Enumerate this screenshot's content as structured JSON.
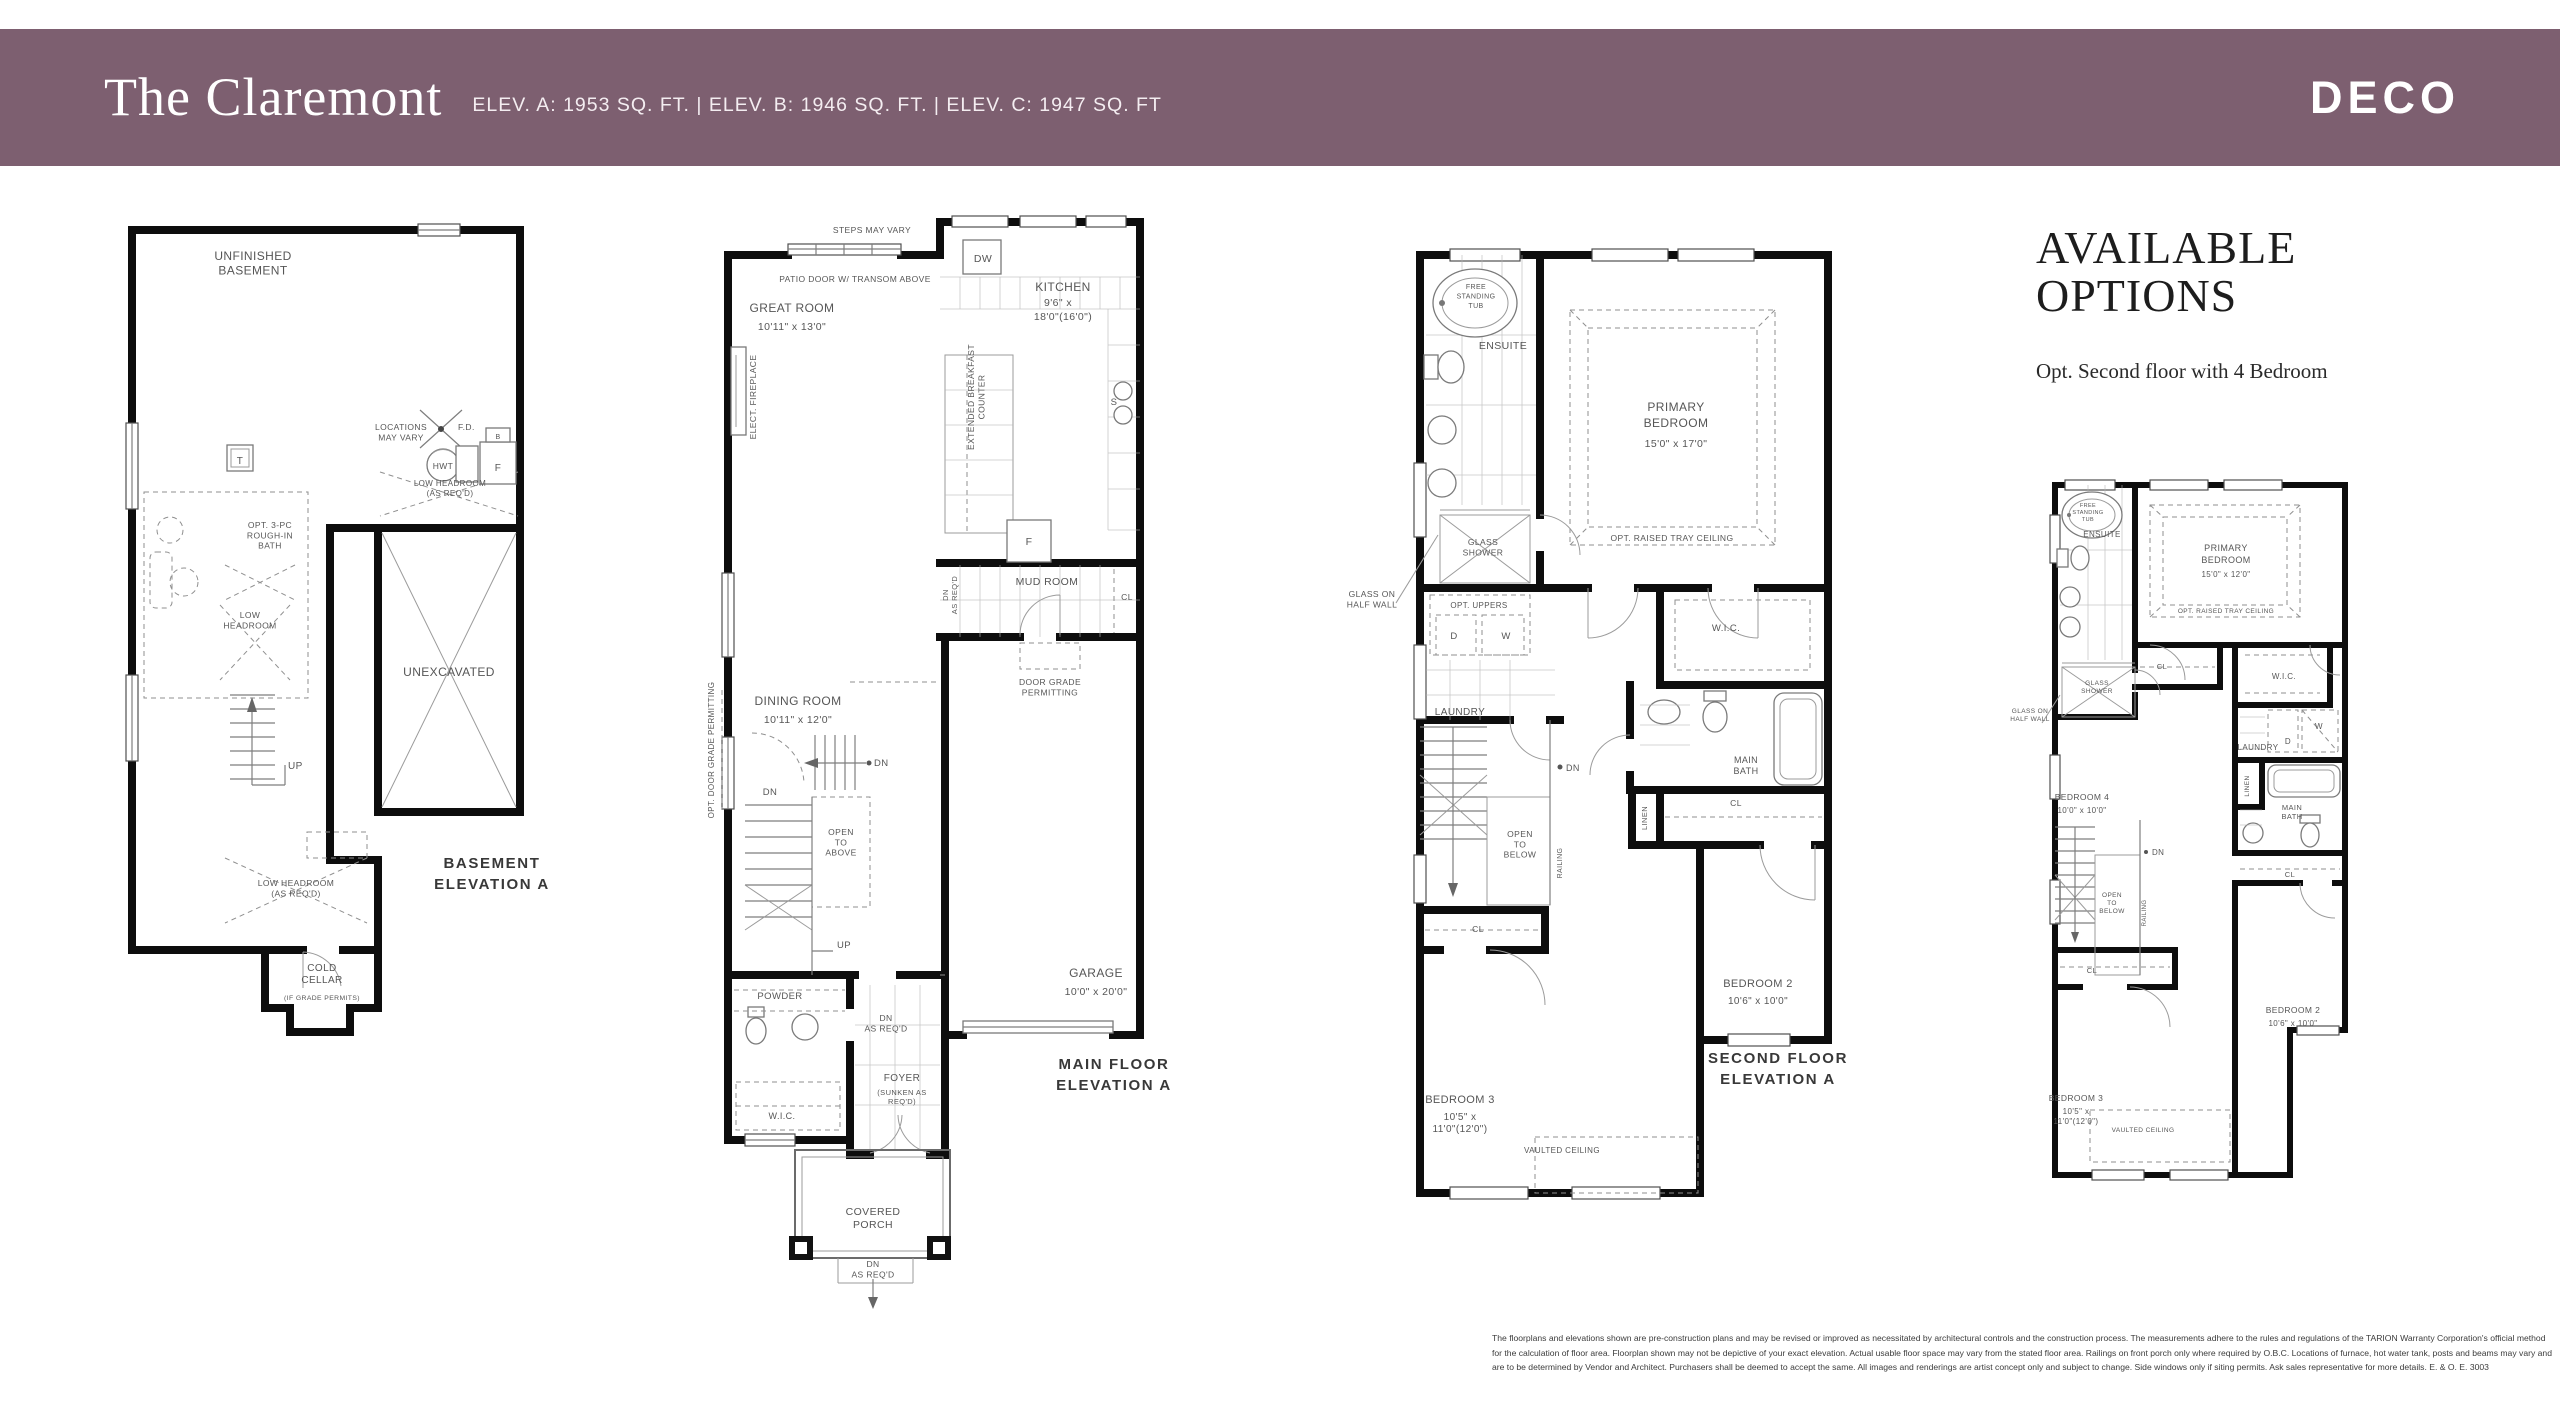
{
  "header": {
    "title": "The Claremont",
    "specs": "ELEV. A: 1953 SQ. FT.  |  ELEV. B: 1946 SQ. FT.  |  ELEV. C: 1947 SQ. FT",
    "brand": "DECO",
    "bar_color": "#7d5f70"
  },
  "options": {
    "title": "AVAILABLE\nOPTIONS",
    "subtitle": "Opt. Second floor with 4 Bedroom"
  },
  "plans": {
    "basement": {
      "labels": [
        {
          "t": "UNFINISHED\nBASEMENT",
          "x": 133,
          "y": 80,
          "s": 12,
          "ls": 1
        },
        {
          "t": "T",
          "x": 120,
          "y": 284,
          "s": 10
        },
        {
          "t": "LOCATIONS\nMAY VARY",
          "x": 281,
          "y": 250,
          "s": 8.5
        },
        {
          "t": "F.D.",
          "x": 338,
          "y": 250,
          "s": 8.5,
          "a": "start"
        },
        {
          "t": "HWT",
          "x": 323,
          "y": 289,
          "s": 8.5
        },
        {
          "t": "B",
          "x": 378,
          "y": 259,
          "s": 7
        },
        {
          "t": "F",
          "x": 378,
          "y": 291,
          "s": 10
        },
        {
          "t": "LOW HEADROOM\n(AS REQ'D)",
          "x": 330,
          "y": 306,
          "s": 8
        },
        {
          "t": "OPT. 3-PC\nROUGH-IN\nBATH",
          "x": 150,
          "y": 348,
          "s": 8.5
        },
        {
          "t": "LOW\nHEADROOM",
          "x": 130,
          "y": 438,
          "s": 8.5
        },
        {
          "t": "UP",
          "x": 168,
          "y": 589,
          "s": 10,
          "a": "start"
        },
        {
          "t": "LOW HEADROOM\n(AS REQ'D)",
          "x": 176,
          "y": 706,
          "s": 8.5
        },
        {
          "t": "UNEXCAVATED",
          "x": 329,
          "y": 496,
          "s": 12,
          "ls": 1
        },
        {
          "t": "COLD\nCELLAR",
          "x": 202,
          "y": 791,
          "s": 10,
          "ls": 0.5
        },
        {
          "t": "(IF GRADE PERMITS)",
          "x": 202,
          "y": 820,
          "s": 6.8
        },
        {
          "t": "BASEMENT\nELEVATION A",
          "x": 372,
          "y": 688,
          "s": 15,
          "c": "cap",
          "lh": 21
        }
      ]
    },
    "main": {
      "labels": [
        {
          "t": "STEPS MAY VARY",
          "x": 182,
          "y": 48,
          "s": 8.5
        },
        {
          "t": "PATIO DOOR W/ TRANSOM ABOVE",
          "x": 165,
          "y": 97,
          "s": 8.5
        },
        {
          "t": "GREAT ROOM",
          "x": 102,
          "y": 127,
          "s": 12,
          "ls": 1
        },
        {
          "t": "10'11\" x 13'0\"",
          "x": 102,
          "y": 145,
          "s": 10.5
        },
        {
          "t": "ELECT. FIREPLACE",
          "x": 66,
          "y": 212,
          "s": 8.5,
          "r": -90
        },
        {
          "t": "DW",
          "x": 293,
          "y": 77,
          "s": 10.5
        },
        {
          "t": "KITCHEN",
          "x": 373,
          "y": 106,
          "s": 12,
          "ls": 1
        },
        {
          "t": "9'6\" x",
          "x": 368,
          "y": 121,
          "s": 10.5
        },
        {
          "t": "18'0\"(16'0\")",
          "x": 373,
          "y": 135,
          "s": 10.5
        },
        {
          "t": "EXTENDED BREAKFAST\nCOUNTER",
          "x": 284,
          "y": 212,
          "s": 8.5,
          "r": -90
        },
        {
          "t": "S",
          "x": 424,
          "y": 220,
          "s": 9.5
        },
        {
          "t": "F",
          "x": 339,
          "y": 360,
          "s": 10.5
        },
        {
          "t": "MUD ROOM",
          "x": 357,
          "y": 400,
          "s": 10.5,
          "ls": 0.5
        },
        {
          "t": "DN\nAS REQ'D",
          "x": 258,
          "y": 410,
          "s": 7.5,
          "r": -90
        },
        {
          "t": "CL",
          "x": 437,
          "y": 415,
          "s": 8.5
        },
        {
          "t": "DOOR GRADE\nPERMITTING",
          "x": 360,
          "y": 500,
          "s": 8.5
        },
        {
          "t": "DINING ROOM",
          "x": 108,
          "y": 520,
          "s": 12,
          "ls": 1
        },
        {
          "t": "10'11\" x 12'0\"",
          "x": 108,
          "y": 538,
          "s": 10.5
        },
        {
          "t": "OPT. DOOR GRADE PERMITTING",
          "x": 24,
          "y": 565,
          "s": 8,
          "r": -90
        },
        {
          "t": "DN",
          "x": 184,
          "y": 581,
          "s": 9.5,
          "a": "start"
        },
        {
          "t": "DN",
          "x": 80,
          "y": 610,
          "s": 9.5
        },
        {
          "t": "OPEN\nTO\nABOVE",
          "x": 151,
          "y": 650,
          "s": 8.5
        },
        {
          "t": "UP",
          "x": 147,
          "y": 763,
          "s": 9.5,
          "a": "start"
        },
        {
          "t": "POWDER",
          "x": 90,
          "y": 814,
          "s": 9.5,
          "ls": 0.5
        },
        {
          "t": "DN\nAS REQ'D",
          "x": 196,
          "y": 836,
          "s": 8.5
        },
        {
          "t": "W.I.C.",
          "x": 92,
          "y": 934,
          "s": 9
        },
        {
          "t": "FOYER",
          "x": 212,
          "y": 896,
          "s": 10,
          "ls": 0.5
        },
        {
          "t": "(SUNKEN AS\nREQ'D)",
          "x": 212,
          "y": 910,
          "s": 7.5
        },
        {
          "t": "GARAGE",
          "x": 406,
          "y": 792,
          "s": 12,
          "ls": 1
        },
        {
          "t": "10'0\" x 20'0\"",
          "x": 406,
          "y": 810,
          "s": 10.5
        },
        {
          "t": "COVERED\nPORCH",
          "x": 183,
          "y": 1030,
          "s": 10.5,
          "ls": 0.5
        },
        {
          "t": "DN\nAS REQ'D",
          "x": 183,
          "y": 1082,
          "s": 8.5
        },
        {
          "t": "MAIN FLOOR\nELEVATION A",
          "x": 424,
          "y": 884,
          "s": 15,
          "c": "cap",
          "lh": 21
        }
      ]
    },
    "second": {
      "labels": [
        {
          "t": "FREE\nSTANDING\nTUB",
          "x": 146,
          "y": 74,
          "s": 7,
          "lh": 9.5
        },
        {
          "t": "ENSUITE",
          "x": 173,
          "y": 134,
          "s": 10.5,
          "ls": 0.5
        },
        {
          "t": "GLASS ON\nHALF WALL",
          "x": 42,
          "y": 382,
          "s": 8.5
        },
        {
          "t": "GLASS\nSHOWER",
          "x": 153,
          "y": 330,
          "s": 8.5
        },
        {
          "t": "PRIMARY\nBEDROOM",
          "x": 346,
          "y": 196,
          "s": 12,
          "ls": 1,
          "lh": 16
        },
        {
          "t": "15'0\" x 17'0\"",
          "x": 346,
          "y": 232,
          "s": 10.5
        },
        {
          "t": "OPT. RAISED TRAY CEILING",
          "x": 342,
          "y": 326,
          "s": 8.5
        },
        {
          "t": "OPT. UPPERS",
          "x": 149,
          "y": 393,
          "s": 8
        },
        {
          "t": "D",
          "x": 124,
          "y": 424,
          "s": 9.5
        },
        {
          "t": "W",
          "x": 176,
          "y": 424,
          "s": 9.5
        },
        {
          "t": "LAUNDRY",
          "x": 130,
          "y": 500,
          "s": 10,
          "ls": 0.5
        },
        {
          "t": "W.I.C.",
          "x": 396,
          "y": 416,
          "s": 9.5
        },
        {
          "t": "MAIN\nBATH",
          "x": 416,
          "y": 548,
          "s": 9
        },
        {
          "t": "DN",
          "x": 236,
          "y": 556,
          "s": 9,
          "a": "start"
        },
        {
          "t": "OPEN\nTO\nBELOW",
          "x": 190,
          "y": 622,
          "s": 8.5
        },
        {
          "t": "RAILING",
          "x": 232,
          "y": 648,
          "s": 7,
          "r": -90
        },
        {
          "t": "LINEN",
          "x": 317,
          "y": 603,
          "s": 7.5,
          "r": -90
        },
        {
          "t": "CL",
          "x": 406,
          "y": 591,
          "s": 8.5
        },
        {
          "t": "CL",
          "x": 148,
          "y": 717,
          "s": 8.5
        },
        {
          "t": "BEDROOM 2",
          "x": 428,
          "y": 772,
          "s": 11,
          "ls": 0.5
        },
        {
          "t": "10'6\" x 10'0\"",
          "x": 428,
          "y": 789,
          "s": 10
        },
        {
          "t": "BEDROOM 3",
          "x": 130,
          "y": 888,
          "s": 11,
          "ls": 0.5
        },
        {
          "t": "10'5\" x\n11'0\"(12'0\")",
          "x": 130,
          "y": 905,
          "s": 10
        },
        {
          "t": "VAULTED CEILING",
          "x": 232,
          "y": 938,
          "s": 8
        },
        {
          "t": "SECOND FLOOR\nELEVATION A",
          "x": 448,
          "y": 848,
          "s": 15,
          "c": "cap",
          "lh": 21
        }
      ]
    },
    "opt4": {
      "labels": [
        {
          "t": "FREE\nSTANDING\nTUB",
          "x": 88,
          "y": 52,
          "s": 5.5,
          "lh": 7
        },
        {
          "t": "ENSUITE",
          "x": 102,
          "y": 82,
          "s": 8
        },
        {
          "t": "GLASS ON\nHALF WALL",
          "x": 30,
          "y": 258,
          "s": 6.5
        },
        {
          "t": "GLASS\nSHOWER",
          "x": 97,
          "y": 230,
          "s": 6.5
        },
        {
          "t": "PRIMARY\nBEDROOM",
          "x": 226,
          "y": 96,
          "s": 9,
          "lh": 12
        },
        {
          "t": "15'0\" x 12'0\"",
          "x": 226,
          "y": 122,
          "s": 8
        },
        {
          "t": "OPT. RAISED TRAY CEILING",
          "x": 226,
          "y": 158,
          "s": 6.5
        },
        {
          "t": "CL",
          "x": 162,
          "y": 214,
          "s": 7.5
        },
        {
          "t": "W.I.C.",
          "x": 284,
          "y": 224,
          "s": 8
        },
        {
          "t": "LAUNDRY",
          "x": 258,
          "y": 295,
          "s": 8
        },
        {
          "t": "W",
          "x": 319,
          "y": 274,
          "s": 8
        },
        {
          "t": "D",
          "x": 288,
          "y": 289,
          "s": 8
        },
        {
          "t": "LINEN",
          "x": 249,
          "y": 331,
          "s": 6.5,
          "r": -90
        },
        {
          "t": "MAIN\nBATH",
          "x": 292,
          "y": 355,
          "s": 7.5
        },
        {
          "t": "BEDROOM 4",
          "x": 82,
          "y": 345,
          "s": 8.5
        },
        {
          "t": "10'0\" x 10'0\"",
          "x": 82,
          "y": 358,
          "s": 8
        },
        {
          "t": "DN",
          "x": 152,
          "y": 400,
          "s": 8,
          "a": "start"
        },
        {
          "t": "OPEN\nTO\nBELOW",
          "x": 112,
          "y": 442,
          "s": 6.5
        },
        {
          "t": "RAILING",
          "x": 146,
          "y": 458,
          "s": 6,
          "r": -90
        },
        {
          "t": "CL",
          "x": 290,
          "y": 422,
          "s": 7.5
        },
        {
          "t": "CL",
          "x": 92,
          "y": 518,
          "s": 7.5
        },
        {
          "t": "BEDROOM 2",
          "x": 293,
          "y": 558,
          "s": 8.5
        },
        {
          "t": "10'6\" x 10'0\"",
          "x": 293,
          "y": 571,
          "s": 8
        },
        {
          "t": "BEDROOM 3",
          "x": 76,
          "y": 646,
          "s": 8.5
        },
        {
          "t": "10'5\" x\n11'0\"(12'0\")",
          "x": 76,
          "y": 659,
          "s": 8
        },
        {
          "t": "VAULTED CEILING",
          "x": 143,
          "y": 677,
          "s": 6.5
        }
      ]
    }
  },
  "disclaimer": {
    "lines": [
      "The floorplans and elevations shown are pre-construction plans and may be revised or improved as necessitated by architectural controls and the construction process. The measurements adhere to the rules and regulations of the TARION Warranty Corporation's official method",
      "for the calculation of floor area. Floorplan shown may not be depictive of your exact elevation. Actual usable floor space may vary from the stated floor area. Railings on front porch only where required by O.B.C. Locations of furnace, hot water tank, posts and beams may vary and",
      "are to be determined by Vendor and Architect. Purchasers shall be deemed to accept the same. All images and renderings are artist concept only and subject to change. Side windows only if siting permits. Ask sales representative for more details. E. & O. E. 3003"
    ]
  }
}
